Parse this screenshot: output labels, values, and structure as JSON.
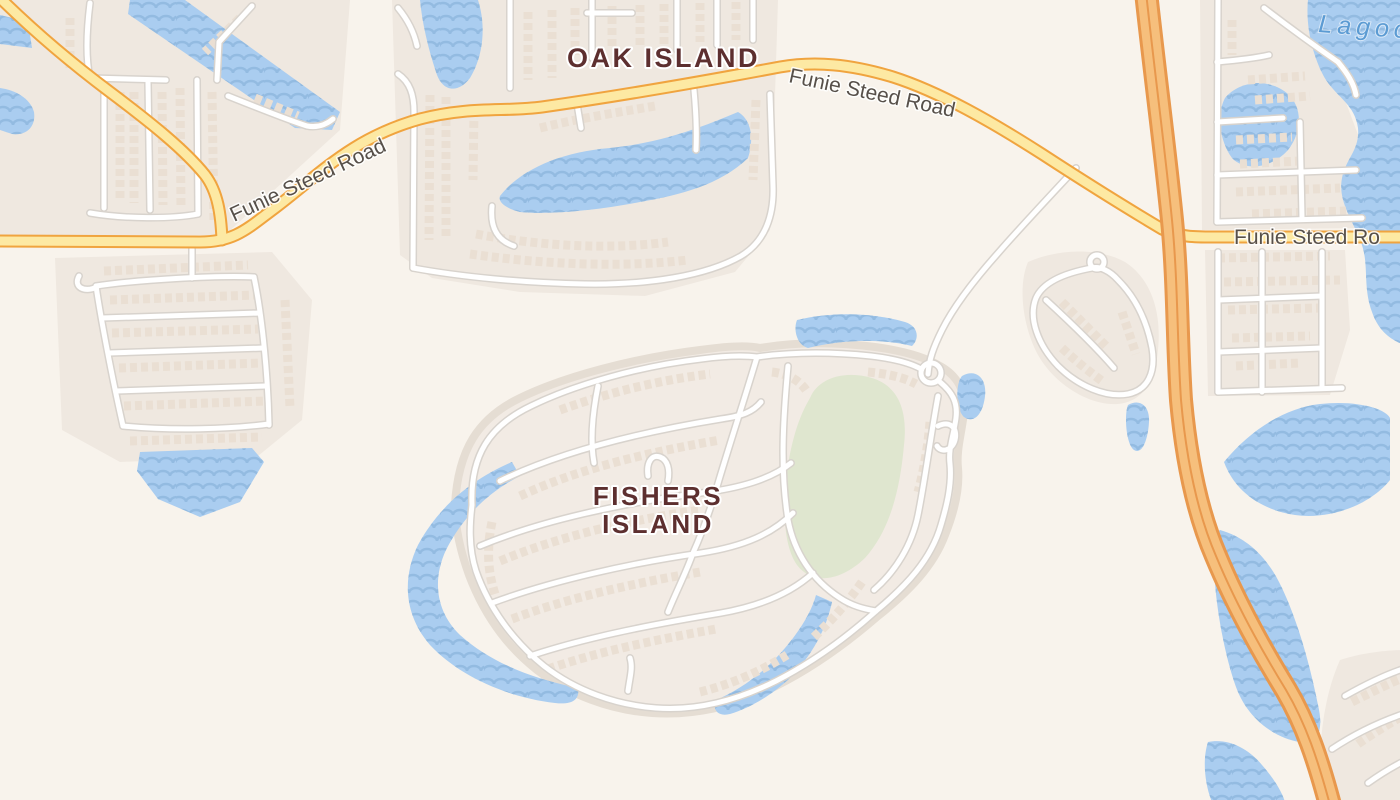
{
  "map": {
    "background_color": "#f8f3ec",
    "colors": {
      "residential": "#efe8e0",
      "island": "#f2ebe4",
      "water": "#aacdf0",
      "water_wave": "#8fb8de",
      "park": "#dfe6cf",
      "road_fill": "#fde9a3",
      "road_casing": "#f0a43f",
      "highway_fill": "#f6bf7c",
      "highway_casing": "#e8984d",
      "street_fill": "#ffffff",
      "street_casing": "#d8d3cd",
      "building": "#eadfd3",
      "place_label": "#5d2f2f",
      "road_label": "#57504a",
      "water_label": "#5b9bd3"
    },
    "place_labels": [
      {
        "id": "oak-island",
        "text": "OAK ISLAND"
      },
      {
        "id": "fishers-island",
        "line1": "FISHERS",
        "line2": "ISLAND"
      }
    ],
    "road_labels": [
      {
        "id": "funie-steed-road-west",
        "text": "Funie Steed Road"
      },
      {
        "id": "funie-steed-road-mid",
        "text": "Funie Steed Road"
      },
      {
        "id": "funie-steed-road-east",
        "text": "Funie Steed Ro"
      }
    ],
    "water_labels": [
      {
        "id": "lagoon",
        "text": "Lagoon"
      }
    ]
  }
}
